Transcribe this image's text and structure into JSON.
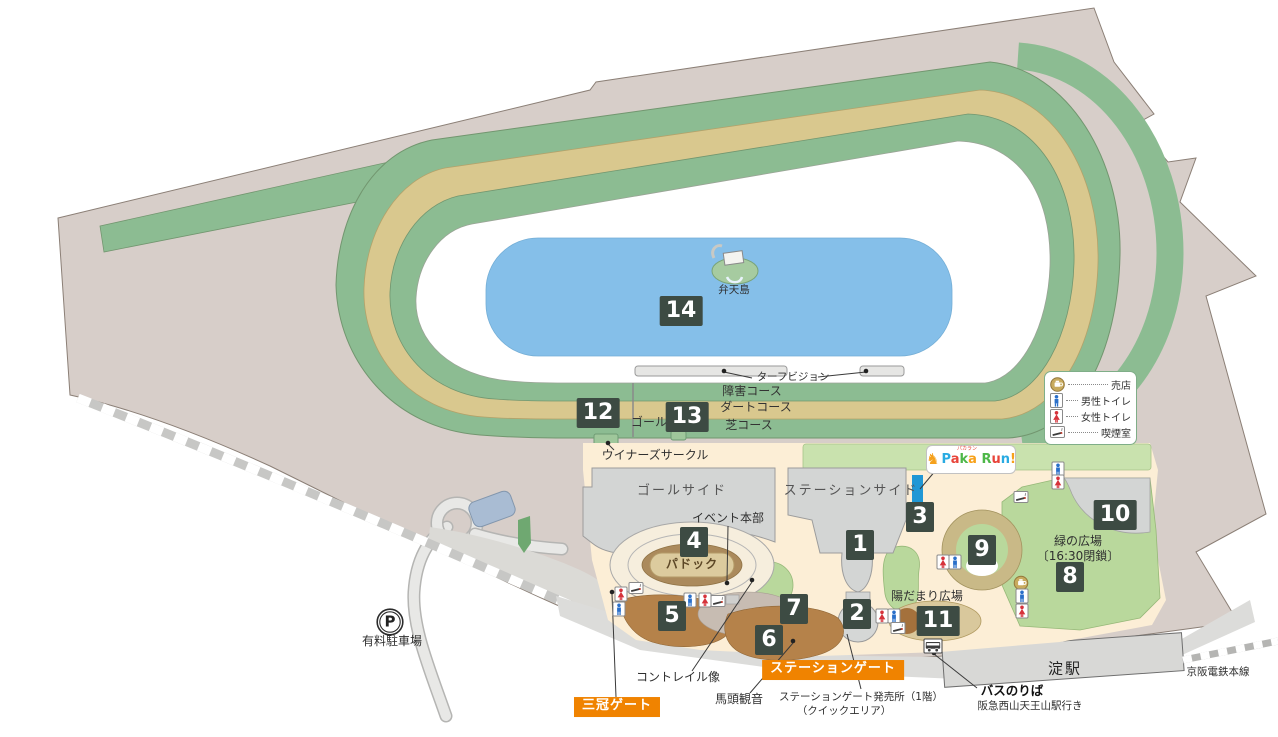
{
  "legend": {
    "items": [
      {
        "icon": "shop-icon",
        "label": "売店"
      },
      {
        "icon": "male-toilet-icon",
        "label": "男性トイレ"
      },
      {
        "icon": "female-toilet-icon",
        "label": "女性トイレ"
      },
      {
        "icon": "smoking-room-icon",
        "label": "喫煙室"
      }
    ]
  },
  "logo": {
    "sub": "パカラン",
    "horse_glyph": "♞",
    "letters": [
      {
        "ch": "P",
        "color": "#29abe2"
      },
      {
        "ch": "a",
        "color": "#e8443a"
      },
      {
        "ch": "k",
        "color": "#4db748"
      },
      {
        "ch": "a",
        "color": "#f7a11a"
      },
      {
        "ch": " ",
        "color": "#333333"
      },
      {
        "ch": "R",
        "color": "#4db748"
      },
      {
        "ch": "u",
        "color": "#e8443a"
      },
      {
        "ch": "n",
        "color": "#29abe2"
      },
      {
        "ch": "!",
        "color": "#f7a11a"
      }
    ]
  },
  "markers": [
    {
      "number": "1",
      "x": 860,
      "y": 545
    },
    {
      "number": "2",
      "x": 857,
      "y": 614
    },
    {
      "number": "3",
      "x": 920,
      "y": 517
    },
    {
      "number": "4",
      "x": 694,
      "y": 542
    },
    {
      "number": "5",
      "x": 672,
      "y": 616
    },
    {
      "number": "6",
      "x": 769,
      "y": 640
    },
    {
      "number": "7",
      "x": 794,
      "y": 609
    },
    {
      "number": "8",
      "x": 1070,
      "y": 577
    },
    {
      "number": "9",
      "x": 982,
      "y": 550
    },
    {
      "number": "10",
      "x": 1115,
      "y": 515
    },
    {
      "number": "11",
      "x": 938,
      "y": 621
    },
    {
      "number": "12",
      "x": 598,
      "y": 413
    },
    {
      "number": "13",
      "x": 687,
      "y": 417
    },
    {
      "number": "14",
      "x": 681,
      "y": 311
    }
  ],
  "labels": [
    {
      "id": "turf-vision",
      "text": "ターフビジョン",
      "x": 793,
      "y": 377,
      "cls": "sm"
    },
    {
      "id": "jump-course",
      "text": "障害コース",
      "x": 752,
      "y": 392,
      "cls": "course"
    },
    {
      "id": "dirt-course",
      "text": "ダートコース",
      "x": 756,
      "y": 408,
      "cls": "course"
    },
    {
      "id": "turf-course",
      "text": "芝コース",
      "x": 749,
      "y": 426,
      "cls": "course"
    },
    {
      "id": "goal-text",
      "text": "ゴール",
      "x": 649,
      "y": 423,
      "cls": "course"
    },
    {
      "id": "winners-circle",
      "text": "ウイナーズサークル",
      "x": 655,
      "y": 456,
      "cls": ""
    },
    {
      "id": "bentenjima",
      "text": "弁天島",
      "x": 734,
      "y": 290,
      "cls": "sm"
    },
    {
      "id": "goal-side",
      "text": "ゴールサイド",
      "x": 682,
      "y": 492,
      "cls": "area"
    },
    {
      "id": "station-side",
      "text": "ステーションサイド",
      "x": 851,
      "y": 492,
      "cls": "area"
    },
    {
      "id": "event-hq",
      "text": "イベント本部",
      "x": 728,
      "y": 519,
      "cls": ""
    },
    {
      "id": "paddock",
      "text": "パドック",
      "x": 692,
      "y": 565,
      "cls": "paddock"
    },
    {
      "id": "hidamari-plaza",
      "text": "陽だまり広場",
      "x": 927,
      "y": 597,
      "cls": ""
    },
    {
      "id": "midori-plaza",
      "text": "緑の広場",
      "x": 1078,
      "y": 542,
      "cls": ""
    },
    {
      "id": "midori-plaza-note",
      "text": "〔16:30閉鎖〕",
      "x": 1078,
      "y": 557,
      "cls": ""
    },
    {
      "id": "sankan-gate",
      "text": "三冠ゲート",
      "x": 617,
      "y": 707,
      "cls": "orange"
    },
    {
      "id": "station-gate",
      "text": "ステーションゲート",
      "x": 833,
      "y": 670,
      "cls": "orange"
    },
    {
      "id": "contrail-statue",
      "text": "コントレイル像",
      "x": 678,
      "y": 678,
      "cls": ""
    },
    {
      "id": "bato-kannon",
      "text": "馬頭観音",
      "x": 739,
      "y": 700,
      "cls": ""
    },
    {
      "id": "ticket-office-1",
      "text": "ステーションゲート発売所（1階）",
      "x": 861,
      "y": 697,
      "cls": "sm"
    },
    {
      "id": "ticket-office-2",
      "text": "（クイックエリア）",
      "x": 844,
      "y": 711,
      "cls": "sm"
    },
    {
      "id": "bus-stop",
      "text": "バスのりば",
      "x": 1012,
      "y": 691,
      "cls": "boldlbl"
    },
    {
      "id": "bus-stop-dest",
      "text": "阪急西山天王山駅行き",
      "x": 1030,
      "y": 706,
      "cls": "sm"
    },
    {
      "id": "yodo-station",
      "text": "淀駅",
      "x": 1065,
      "y": 669,
      "cls": "yodo"
    },
    {
      "id": "keihan-line",
      "text": "京阪電鉄本線",
      "x": 1218,
      "y": 672,
      "cls": "sm"
    },
    {
      "id": "parking-glyph",
      "text": "P",
      "x": 390,
      "y": 622,
      "cls": "parkp"
    },
    {
      "id": "paid-parking",
      "text": "有料駐車場",
      "x": 392,
      "y": 642,
      "cls": ""
    }
  ],
  "icons": [
    {
      "type": "smoking-room-icon",
      "x": 636,
      "y": 588
    },
    {
      "type": "female-toilet-icon",
      "x": 621,
      "y": 594
    },
    {
      "type": "male-toilet-icon",
      "x": 619,
      "y": 609
    },
    {
      "type": "male-toilet-icon",
      "x": 690,
      "y": 600
    },
    {
      "type": "female-toilet-icon",
      "x": 705,
      "y": 600
    },
    {
      "type": "smoking-room-icon",
      "x": 718,
      "y": 601
    },
    {
      "type": "female-toilet-icon",
      "x": 882,
      "y": 616
    },
    {
      "type": "male-toilet-icon",
      "x": 894,
      "y": 616
    },
    {
      "type": "smoking-room-icon",
      "x": 898,
      "y": 628
    },
    {
      "type": "female-toilet-icon",
      "x": 943,
      "y": 562
    },
    {
      "type": "male-toilet-icon",
      "x": 955,
      "y": 562
    },
    {
      "type": "male-toilet-icon",
      "x": 1058,
      "y": 469
    },
    {
      "type": "female-toilet-icon",
      "x": 1058,
      "y": 482
    },
    {
      "type": "smoking-room-icon",
      "x": 1021,
      "y": 497
    },
    {
      "type": "shop-icon",
      "x": 1021,
      "y": 583
    },
    {
      "type": "male-toilet-icon",
      "x": 1022,
      "y": 596
    },
    {
      "type": "female-toilet-icon",
      "x": 1022,
      "y": 611
    },
    {
      "type": "bus-stop-icon",
      "x": 933,
      "y": 646
    },
    {
      "type": "parking-icon",
      "x": 390,
      "y": 622
    }
  ],
  "colors": {
    "accent_orange": "#f08300",
    "marker_bg": "#3d4b43",
    "turf_green": "#8cbc92",
    "dirt_tan": "#d9c88e",
    "pond_blue": "#85bfe9",
    "land_gray": "#d7cec9",
    "lawn_green": "#b9d89c",
    "stand_gray": "#d3d5d4",
    "plaza_cream": "#fceed6",
    "terrace_brown": "#b5824a"
  }
}
